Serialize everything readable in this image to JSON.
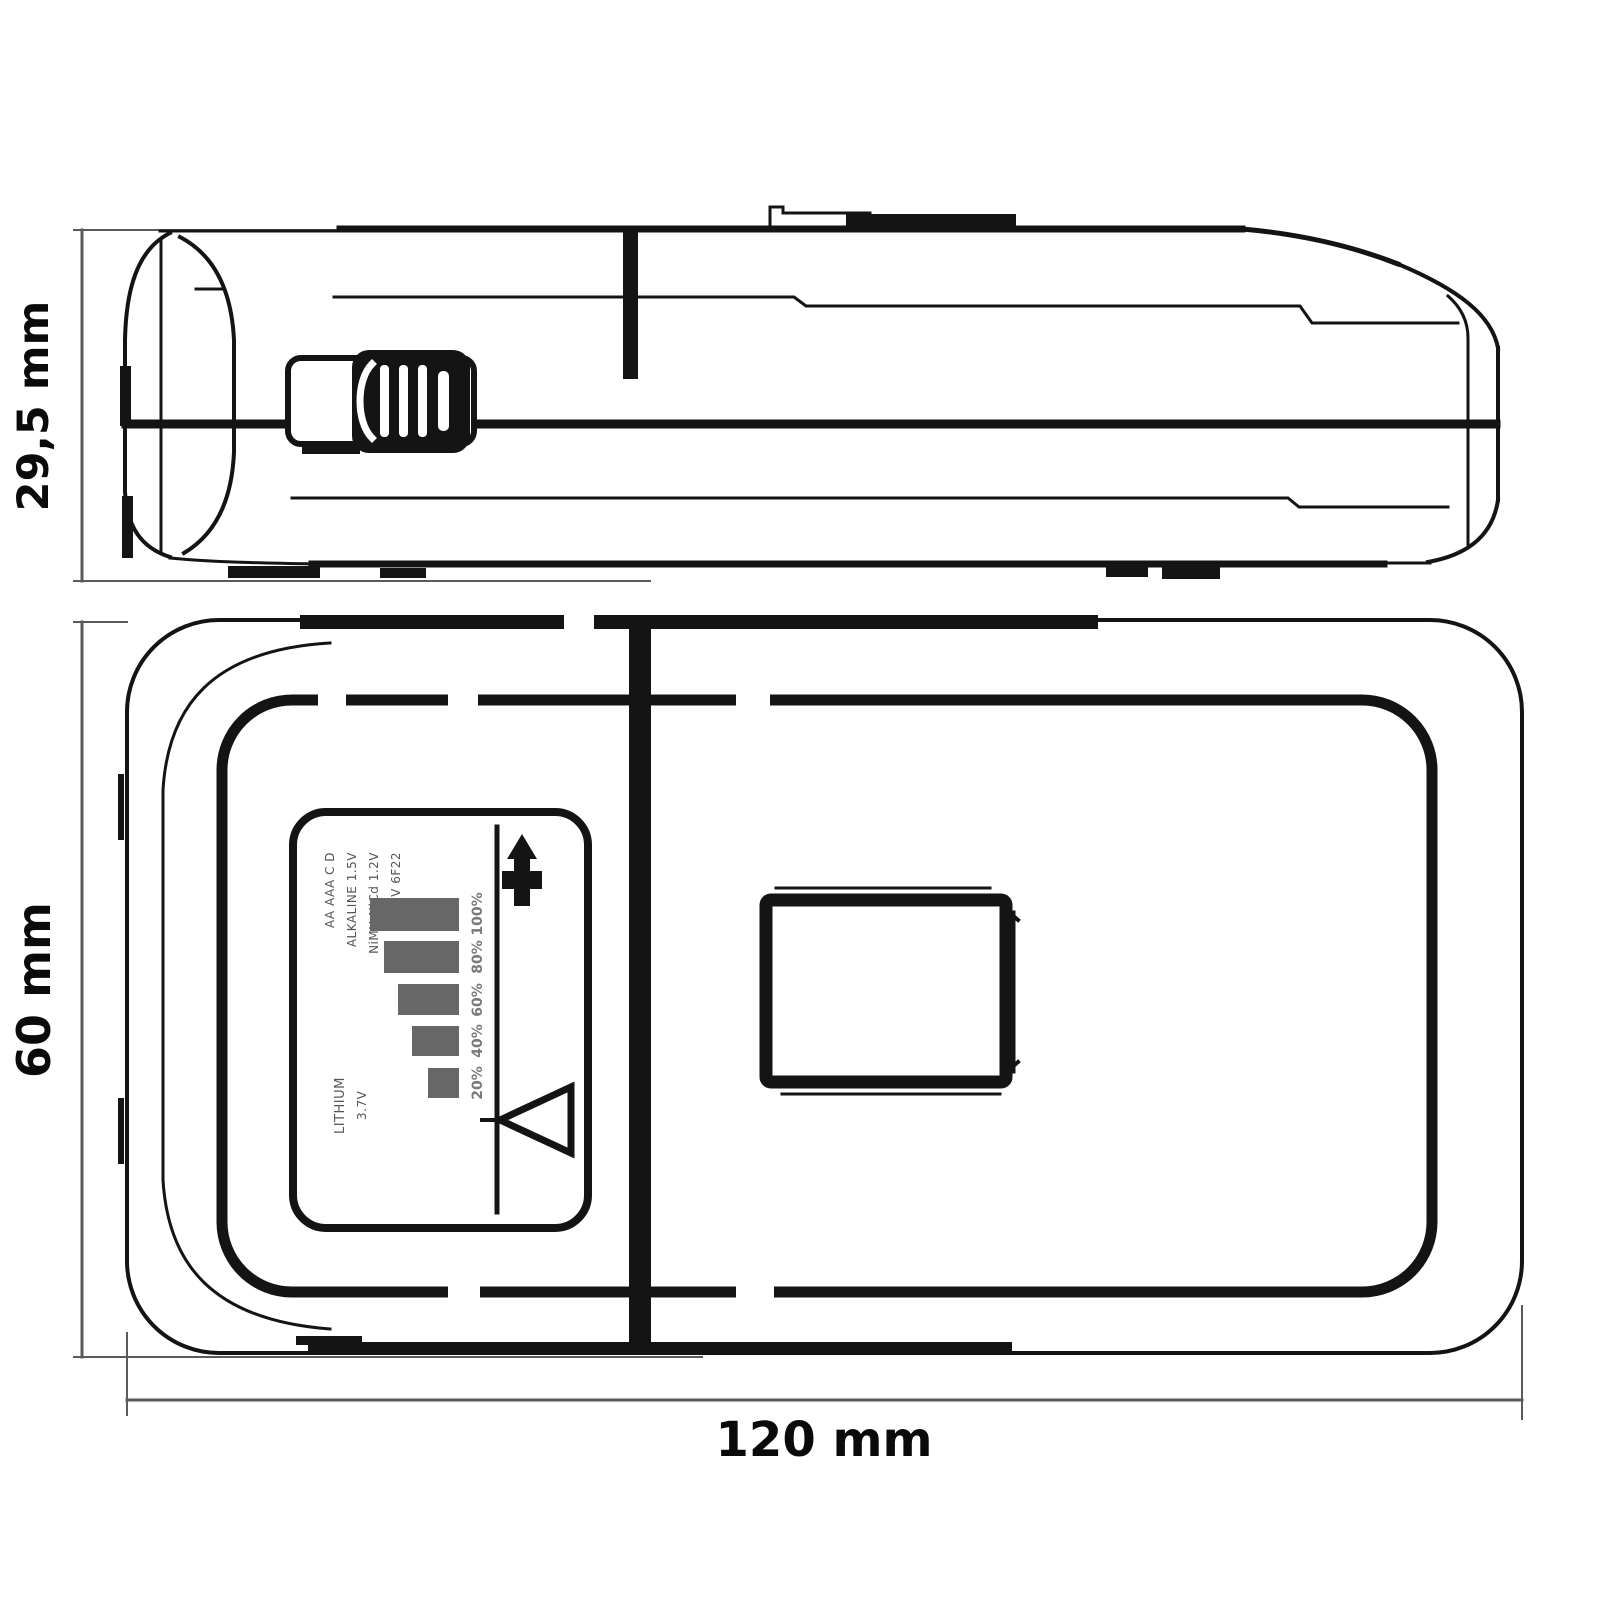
{
  "drawing": {
    "title": "battery tester dimensional drawing, side elevation and top plan views",
    "background": "#ffffff",
    "line_color": "#141414",
    "dim_line_color": "#5a5a5a",
    "dimensions": {
      "height": "29,5 mm",
      "depth": "60 mm",
      "width": "120 mm"
    }
  },
  "side_view": {
    "name": "side elevation",
    "visible_parts": [
      "slider-switch",
      "latch-tab",
      "parting-line",
      "rubber-feet",
      "rounded-end-caps"
    ]
  },
  "plan_view": {
    "name": "top plan",
    "visible_parts": [
      "rating-label",
      "battery-door",
      "parting-line",
      "housing-seam"
    ]
  },
  "label": {
    "micro_text_top_lines": [
      "AA AAA C D",
      "ALKALINE 1.5V",
      "NiMH NiCd 1.2V",
      "9V 6F22"
    ],
    "micro_text_bottom_lines": [
      "LITHIUM",
      "3.7V"
    ],
    "note": "micro text approximate (illegible at source resolution)",
    "icons": [
      "up-arrow-icon",
      "left-triangle-icon"
    ]
  },
  "chart_data": {
    "type": "bar",
    "title": "battery level scale (label artwork)",
    "categories": [
      "100%",
      "80%",
      "60%",
      "40%",
      "20%"
    ],
    "values": [
      100,
      80,
      60,
      40,
      20
    ],
    "orientation": "horizontal",
    "bar_color": "#676767",
    "legend": "none",
    "grid": "off"
  }
}
